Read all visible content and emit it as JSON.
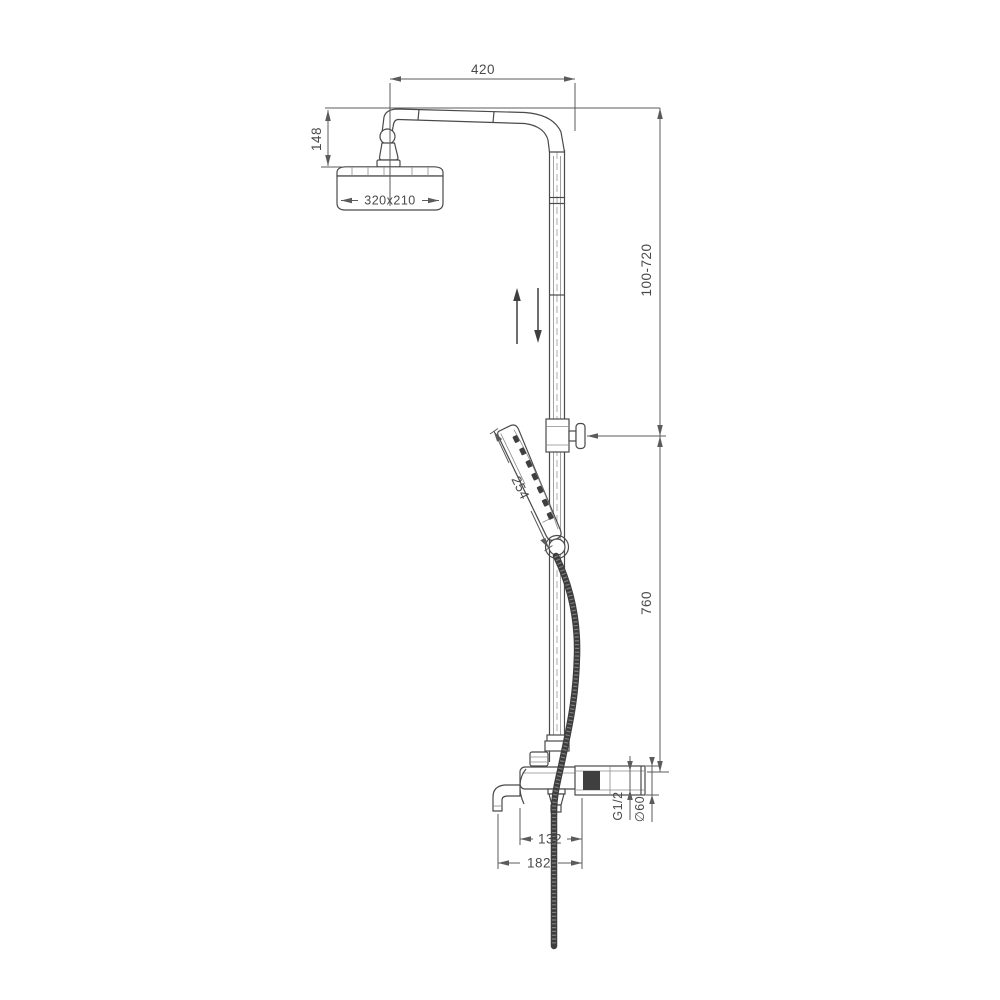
{
  "meta": {
    "type": "technical-drawing",
    "subject": "wall-mounted shower column with overhead shower, adjustable riser, hand shower and bath spout"
  },
  "labels": {
    "arm_projection": "420",
    "head_offset": "148",
    "head_size": "320x210",
    "adjustable_range": "100-720",
    "handset_length": "254",
    "lower_column": "760",
    "thread_size": "G1/2",
    "escutcheon_diameter": "∅60",
    "spout_reach": "132",
    "spout_overall": "182"
  },
  "colors": {
    "line": "#4a4a4a",
    "dimension": "#5b5b5b",
    "hose": "#3d3d3d",
    "background": "#ffffff"
  }
}
